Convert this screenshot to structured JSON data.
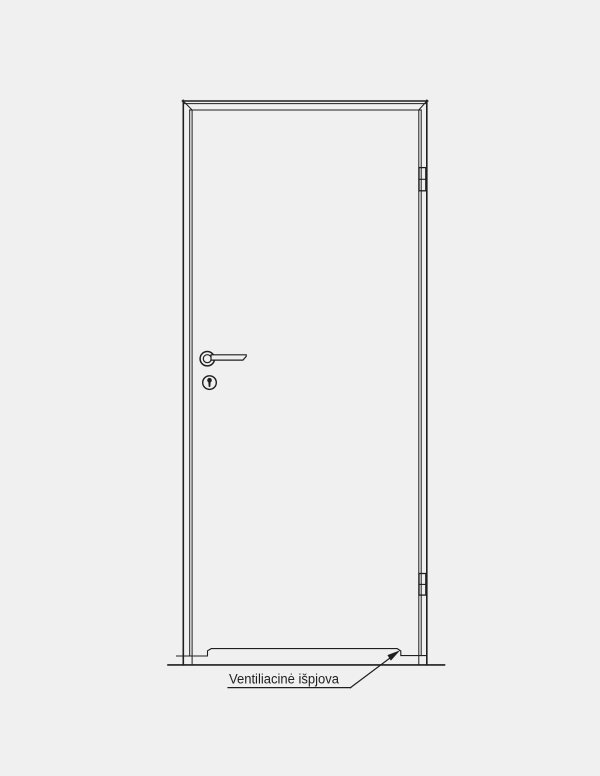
{
  "drawing": {
    "annotation": {
      "label": "Ventiliacinė išpjova"
    },
    "colors": {
      "background": "#f0f0f0",
      "line": "#1f1f1f",
      "text": "#1f1f1f"
    }
  }
}
